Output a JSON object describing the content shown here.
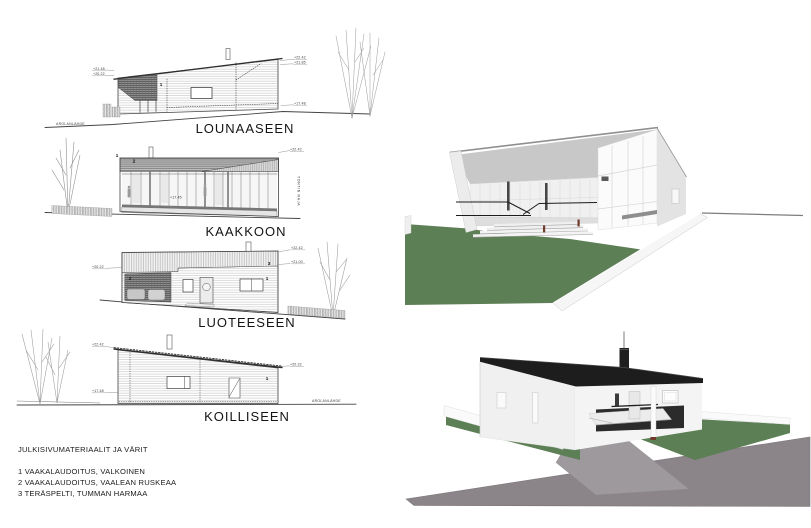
{
  "elevations": [
    {
      "id": "southwest",
      "label": "LOUNAASEEN",
      "site_label": "AROLANLÄHDE",
      "markers": [
        "1"
      ],
      "annotations_left": [
        "+21.48",
        "+20.22"
      ],
      "annotations_right": [
        "+22.42",
        "+21.85",
        "+17.48"
      ]
    },
    {
      "id": "southeast",
      "label": "KAAKKOON",
      "boundary_label": "TONTIN RAJA",
      "markers": [
        "1",
        "2"
      ],
      "annotations_right": [
        "+22.42"
      ],
      "annotations_mid": [
        "+17.45"
      ]
    },
    {
      "id": "northwest",
      "label": "LUOTEESEEN",
      "markers": [
        "2",
        "3",
        "1"
      ],
      "annotations_left": [
        "+20.22"
      ],
      "annotations_right": [
        "+22.42",
        "+21.00"
      ]
    },
    {
      "id": "northeast",
      "label": "KOILLISEEN",
      "site_label": "AROLANLÄHDE",
      "markers": [
        "1"
      ],
      "annotations_left": [
        "+22.42",
        "+17.48"
      ],
      "annotations_right": [
        "+20.32"
      ]
    }
  ],
  "legend": {
    "heading": "JULKISIVUMATERIAALIT JA VÄRIT",
    "items": [
      "1  VAAKALAUDOITUS, VALKOINEN",
      "2  VAAKALAUDOITUS, VAALEAN RUSKEAA",
      "3  TERÄSPELTI, TUMMAN HARMAA"
    ]
  },
  "colors": {
    "lawn_green": "#5d7f55",
    "roof_dark": "#1d1d1d",
    "road_gray": "#8b8589",
    "driveway_gray": "#9d999c",
    "wood_brown": "#70392b",
    "line_dark": "#444444"
  }
}
